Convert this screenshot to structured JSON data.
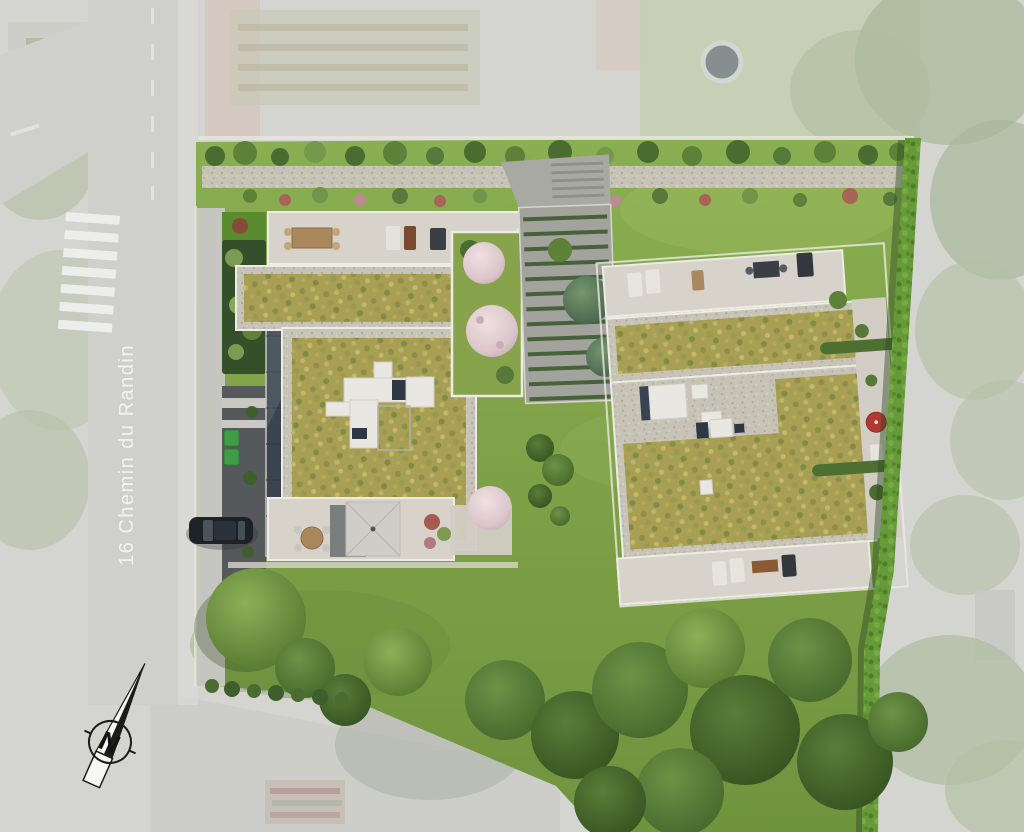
{
  "scene": {
    "type": "architectural-site-plan-aerial-render",
    "street": {
      "label": "16 Chemin du Randin"
    },
    "compass": {
      "label": "N"
    }
  },
  "colors": {
    "backdrop_faded": "#d4d5d0",
    "road_faded": "#cfd0cc",
    "crosswalk_white": "#ededeb",
    "street_label_white": "#f4f4f2",
    "lawn_bright": "#7f9f49",
    "lawn_deep": "#6f943e",
    "green_roof_sedum": "#a89f55",
    "gravel_border": "#c7c3b7",
    "terrace_paving": "#d7d3ca",
    "parapet_white": "#ecebe5",
    "hedge_green": "#679b39",
    "tree_dark": "#42652c",
    "tree_light": "#6f9444",
    "blossom_pink": "#e2cdd2",
    "driveway_stripe_green": "#3e5a31",
    "asphalt_dark": "#55595c",
    "glass_canopy": "#3c4450",
    "waste_bin_green": "#3f9e45",
    "car_black": "#1e2227",
    "parasol_red": "#b23a31",
    "skylight_white": "#e8e7e2",
    "compass_ink": "#1c1c1c",
    "pool_water": "#868f90"
  }
}
